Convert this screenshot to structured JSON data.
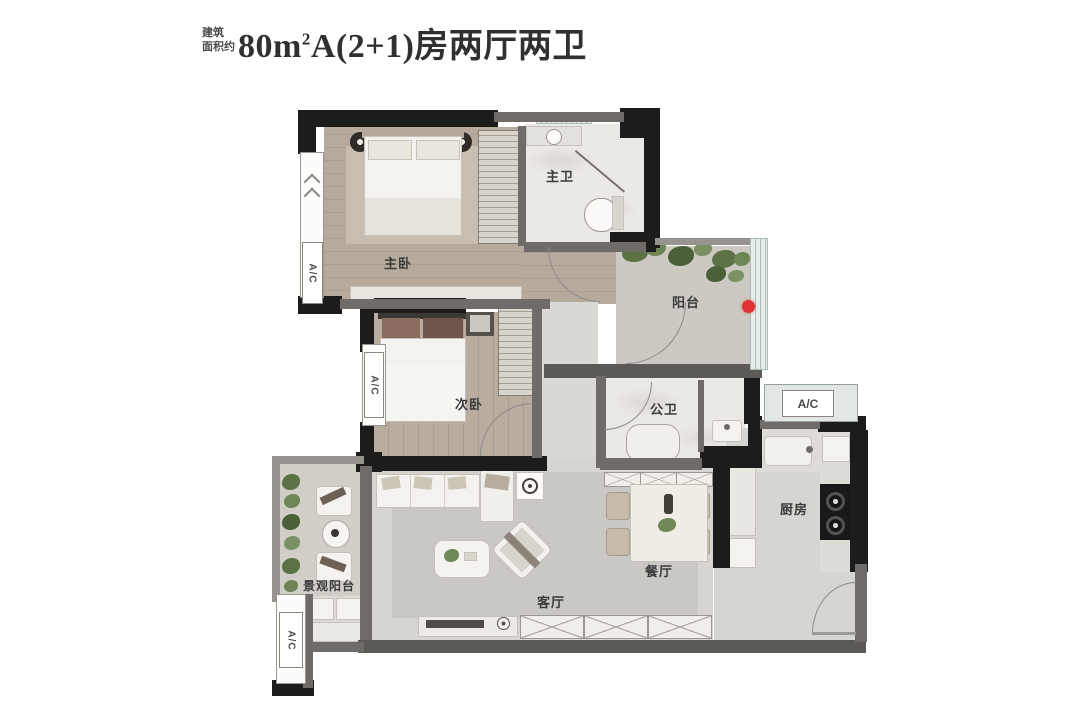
{
  "title": {
    "prefix": [
      "建筑",
      "面积约"
    ],
    "area_number": "80m",
    "area_sup": "2",
    "suffix": "A(2+1)房两厅两卫"
  },
  "rooms": {
    "master_bedroom": "主卧",
    "master_bathroom": "主卫",
    "second_bedroom": "次卧",
    "public_bathroom": "公卫",
    "balcony": "阳台",
    "kitchen": "厨房",
    "dining_room": "餐厅",
    "living_room": "客厅",
    "view_balcony": "景观阳台"
  },
  "labels": {
    "ac": "A/C"
  },
  "icons": {
    "bay_window_marker": "double-chevron-up-icon",
    "balcony_point": "red-dot-marker-icon"
  },
  "colors": {
    "wall_black": "#1c1c1c",
    "wall_gray": "#6e6b68",
    "wood_floor": "#b6aa9d",
    "tile_floor": "#d7d5d1",
    "marble_floor": "#ebe9e6",
    "marker_red": "#e03236"
  }
}
